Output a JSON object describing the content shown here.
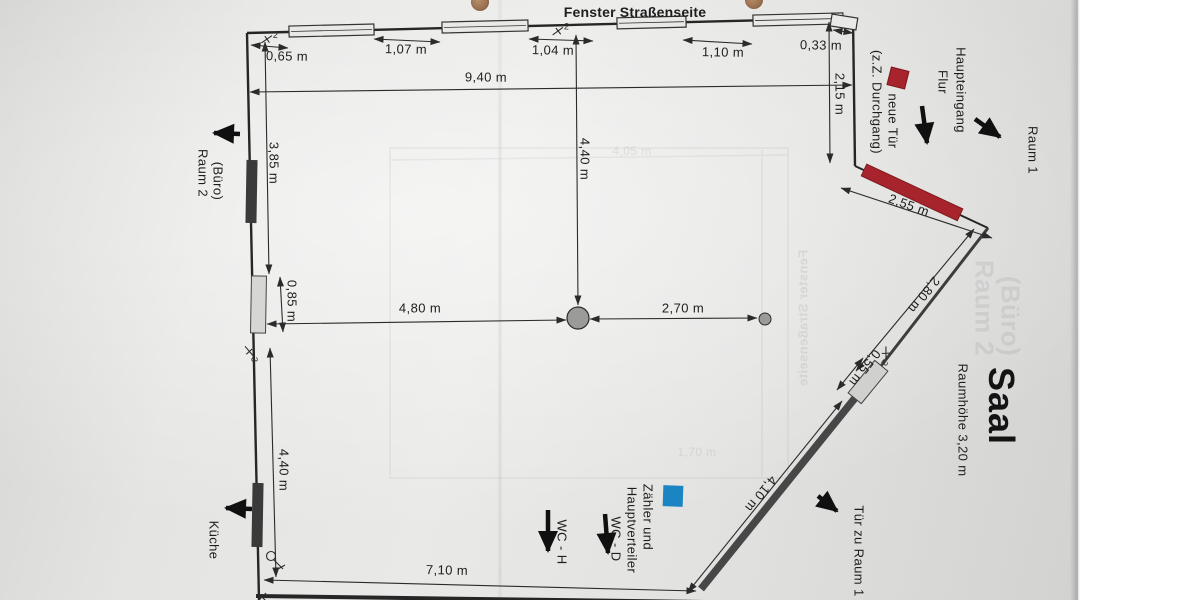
{
  "title": "Fenster Straßenseite",
  "room": {
    "name": "Saal",
    "ceiling_height": "Raumhöhe 3,20 m"
  },
  "annotations": {
    "haupteingang_line1": "Haupteingang",
    "haupteingang_line2": "Flur",
    "raum1": "Raum 1",
    "raum2_line1": "Raum 2",
    "raum2_line2": "(Büro)",
    "kueche": "Küche",
    "tuer_zu_raum1": "Tür zu Raum 1",
    "wc_h": "WC - H",
    "wc_d": "WC - D",
    "zaehler_line1": "Zähler und",
    "zaehler_line2": "Hauptverteiler",
    "neue_tuer_line1": "neue Tür",
    "neue_tuer_line2": "(z.Z. Durchgang)"
  },
  "dimensions": {
    "top_0_65": "0,65 m",
    "top_1_07": "1,07 m",
    "top_1_04": "1,04 m",
    "top_1_10": "1,10 m",
    "top_0_33": "0,33 m",
    "width_9_40": "9,40 m",
    "right_2_15": "2,15 m",
    "diag_2_55": "2,55 m",
    "diag_2_80": "2,80 m",
    "diag_0_55": "0,55 m",
    "diag_4_10": "4,10 m",
    "left_3_85": "3,85 m",
    "left_0_85": "0,85 m",
    "left_4_40": "4,40 m",
    "center_4_40": "4,40 m",
    "center_4_80": "4,80 m",
    "center_2_70": "2,70 m",
    "bottom_7_10": "7,10 m"
  },
  "symbols": {
    "switch_top_left": "2",
    "switch_top_mid": "2",
    "switch_diag": "2",
    "switch_left": "3"
  },
  "ghost_bleedthrough": {
    "dim_4_05": "4,05 m",
    "dim_1_70": "1,70 m",
    "title_mirrored": "Fenster Straßenseite",
    "raum2_line1": "Raum 2",
    "raum2_line2": "(Büro)"
  },
  "colors": {
    "new_door_red": "#a8242c",
    "meter_blue": "#1b84c2",
    "paper": "#e4e4e2",
    "ink": "#2b2b2b",
    "wall_dark": "#474747"
  }
}
